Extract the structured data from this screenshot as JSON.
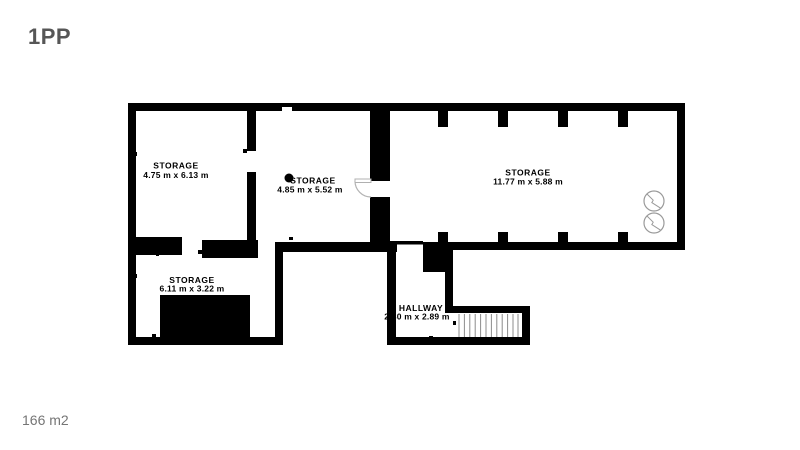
{
  "header": {
    "title": "1PP"
  },
  "footer": {
    "total_area": "166 m2"
  },
  "floorplan": {
    "rooms": [
      {
        "name": "STORAGE",
        "dims": "4.75 m x 6.13 m"
      },
      {
        "name": "STORAGE",
        "dims": "4.85 m x 5.52 m"
      },
      {
        "name": "STORAGE",
        "dims": "11.77 m x 5.88 m"
      },
      {
        "name": "STORAGE",
        "dims": "6.11 m x 3.22 m"
      },
      {
        "name": "HALLWAY",
        "dims": "2.80 m x 2.89 m"
      }
    ],
    "symbols": [
      "door-swing-arc",
      "staircase",
      "fan-symbol",
      "fan-symbol",
      "column-dot"
    ],
    "colors": {
      "wall": "#000000",
      "door_arc": "#b3b3b3",
      "stair_tread": "#8c8c8c",
      "fan_symbol": "#9a9a9a",
      "title_text": "#565656",
      "footer_text": "#757575"
    }
  }
}
